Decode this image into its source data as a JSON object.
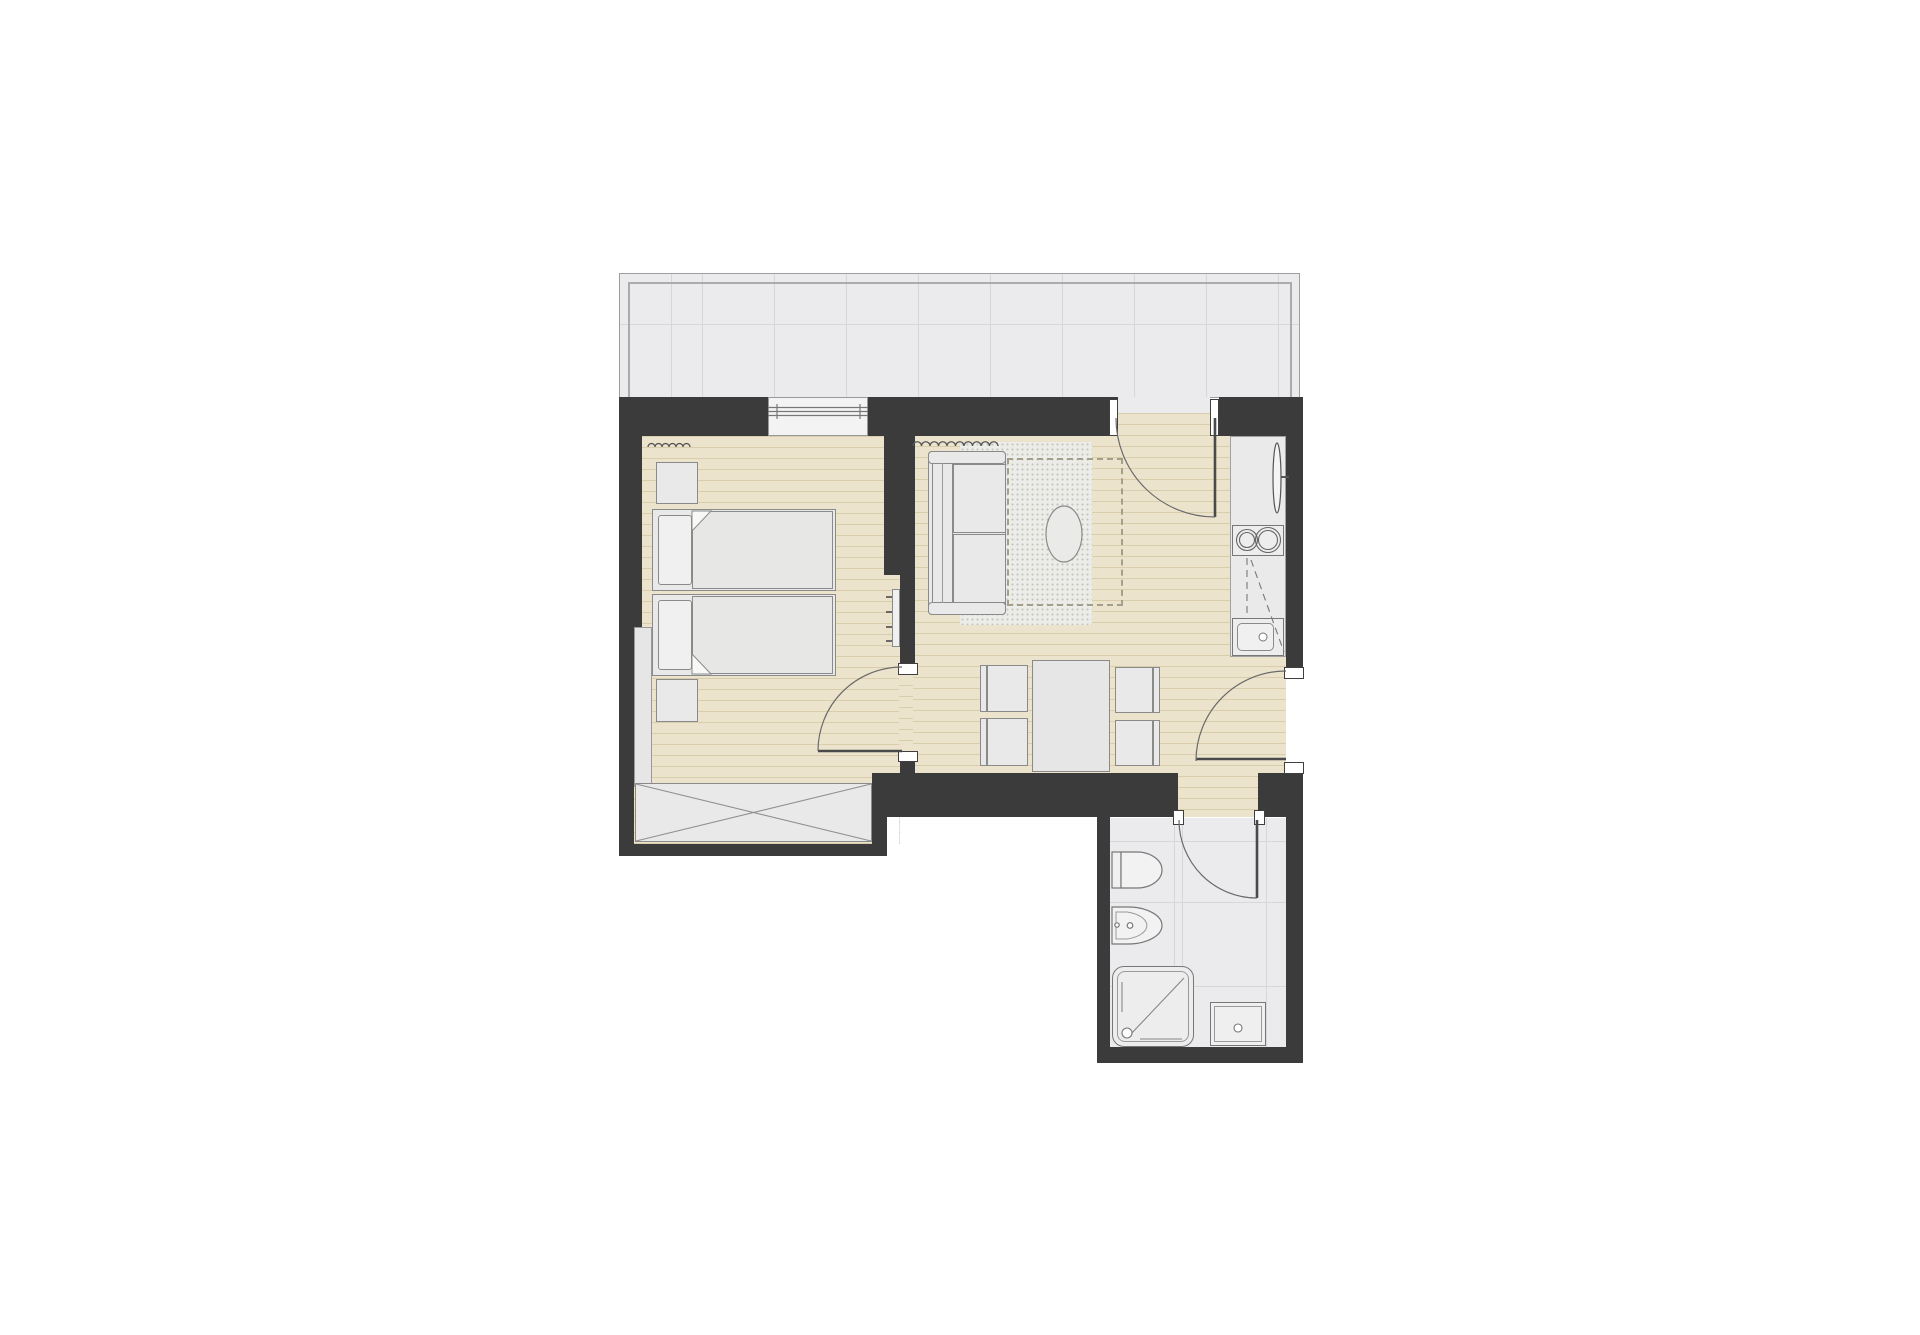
{
  "meta": {
    "title": "Apartment floor plan",
    "drawing_type": "architectural floor plan, top view, no text labels",
    "visible_text": []
  },
  "colors": {
    "canvas": "#ffffff",
    "wall": "#3b3b3b",
    "wood": "#ece3cc",
    "woodline": "#d9cdab",
    "tile": "#ebebed",
    "tileline": "#d7d7d9",
    "tileborder": "#9e9ea2",
    "fixture": "#e9e9e9",
    "fixline": "#8a8a8a",
    "detail": "#666666",
    "door": "#5c5c5c",
    "rug": "#ecece9",
    "rugdot": "#c5c5bf"
  },
  "rooms": [
    {
      "id": "balcony",
      "floor": "tile-grid",
      "features": [
        "thin double border",
        "tile joints"
      ]
    },
    {
      "id": "bedroom",
      "floor": "wood-plank",
      "furniture": [
        "twin-bed-1 with pillow and folded duvet",
        "twin-bed-2 with pillow and folded duvet",
        "nightstand-1",
        "nightstand-2",
        "wardrobe with crossed diagonals",
        "wall-radiator with 4 ticks",
        "curtain at window"
      ],
      "window": "bedroom-window in north wall"
    },
    {
      "id": "living-dining",
      "floor": "wood-plank",
      "furniture": [
        "sofa with two cushions",
        "stippled rug",
        "oval coffee table",
        "dashed sofa-bed outline",
        "curtain",
        "dining-table",
        "four dining chairs"
      ]
    },
    {
      "id": "kitchenette",
      "floor": "tile",
      "furniture": [
        "counter run",
        "two-burner hob",
        "sink with basin and drain",
        "tall slim radiator",
        "dashed upper-cabinet lines"
      ]
    },
    {
      "id": "bathroom",
      "floor": "tile-grid",
      "furniture": [
        "wall-hung-wc",
        "bidet with taps",
        "shower-tray with diagonal and drain",
        "washbasin with drain"
      ]
    }
  ],
  "openings": {
    "doors": [
      {
        "id": "bedroom-door",
        "hinge": "south-jamb",
        "swing": "into-bedroom"
      },
      {
        "id": "balcony-door",
        "hinge": "east-jamb",
        "swing": "into-living-room"
      },
      {
        "id": "entrance-door",
        "hinge": "south-jamb",
        "swing": "into-living-room"
      },
      {
        "id": "bathroom-door",
        "hinge": "east-jamb",
        "swing": "into-bathroom"
      }
    ],
    "windows": [
      {
        "id": "bedroom-window",
        "location": "north-wall",
        "glazing_lines": 3
      }
    ]
  }
}
